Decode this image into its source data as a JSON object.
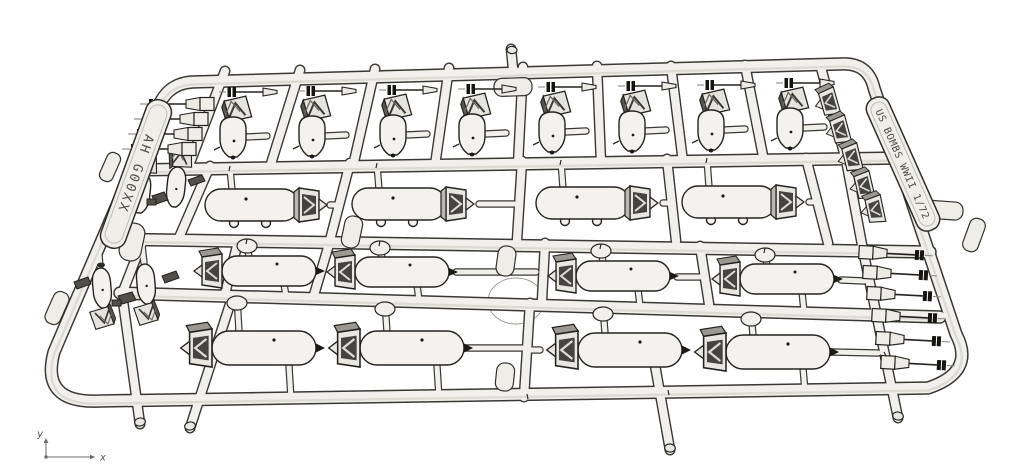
{
  "illustration": {
    "description": "monochrome 3D line render of an injection-molded model kit sprue of WWII US bombs"
  },
  "sprue": {
    "left_tag": "AH G00XX",
    "right_tag": "US BOMBS WWII 1/72"
  },
  "axis_indicator": {
    "x": "x",
    "y": "y"
  },
  "colors": {
    "background": "#ffffff",
    "tube_fill": "#f1f0ec",
    "outline": "#393834",
    "part_fill": "#f3f2ee",
    "accent_black": "#151410",
    "shade": "#dcdbd4"
  },
  "parts_inventory": {
    "row1_vertical_bombs_with_fuzes": 8,
    "row2_bombs_fin_right": 4,
    "row3_bombs_fin_left": 4,
    "row4_large_bombs_fin_left": 4,
    "left_small_bomb_clusters": 2,
    "nose_fuze_spinners_left": 4,
    "nose_fuze_spinners_right": 6,
    "tail_fin_boxes_top_right": 5
  }
}
